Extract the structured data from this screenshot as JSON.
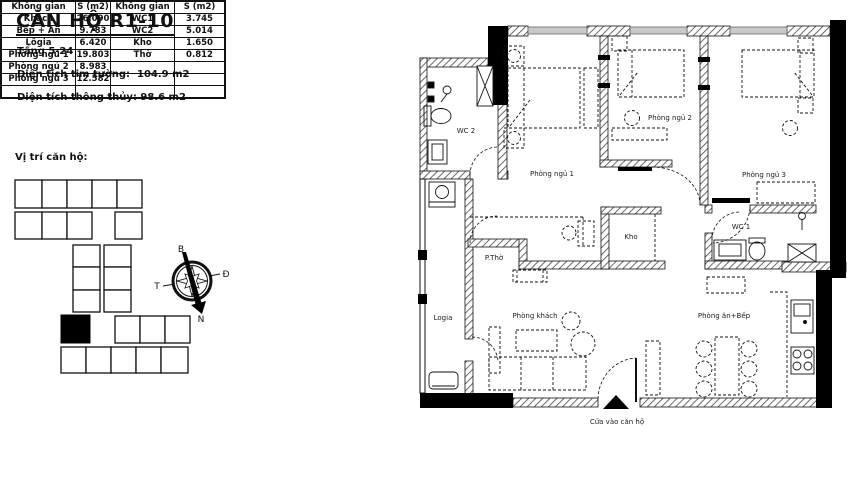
{
  "header": {
    "title": "CĂN HỘ R1-10",
    "floor_range": "Tầng 5-24",
    "gross_area_label": "Diện tích tim tường:",
    "gross_area_value": "104.9 m2",
    "net_area_label": "Diện tích thông thủy:",
    "net_area_value": "98.6 m2",
    "location_label": "Vị trí căn hộ:"
  },
  "compass": {
    "north": "B",
    "east": "Đ",
    "west": "T",
    "south": "N"
  },
  "area_table": {
    "headers": [
      "Không gian",
      "S (m2)",
      "Không gian",
      "S (m2)"
    ],
    "rows": [
      [
        "Khách",
        "26.090",
        "WC1",
        "3.745"
      ],
      [
        "Bếp + Ăn",
        "9.783",
        "WC2",
        "5.014"
      ],
      [
        "Lôgia",
        "6.420",
        "Kho",
        "1.650"
      ],
      [
        "Phòng ngủ 1",
        "19.803",
        "Thờ",
        "0.812"
      ],
      [
        "Phòng ngủ 2",
        "8.983",
        "",
        ""
      ],
      [
        "Phòng ngủ 3",
        "12.582",
        "",
        ""
      ],
      [
        "",
        "",
        "",
        ""
      ]
    ]
  },
  "floor_plan": {
    "rooms": {
      "wc2": "WC 2",
      "bedroom1": "Phòng ngủ 1",
      "bedroom2": "Phòng ngủ 2",
      "bedroom3": "Phòng ngủ 3",
      "storage": "Kho",
      "wc1": "WC 1",
      "altar": "P.Thờ",
      "loggia": "Logia",
      "living": "Phòng khách",
      "dining_kitchen": "Phòng ăn+Bếp"
    },
    "entrance_label": "Cửa vào căn hộ"
  },
  "colors": {
    "wall_black": "#000000",
    "line": "#1a1a1a",
    "window_gray": "#c9c9c9"
  }
}
